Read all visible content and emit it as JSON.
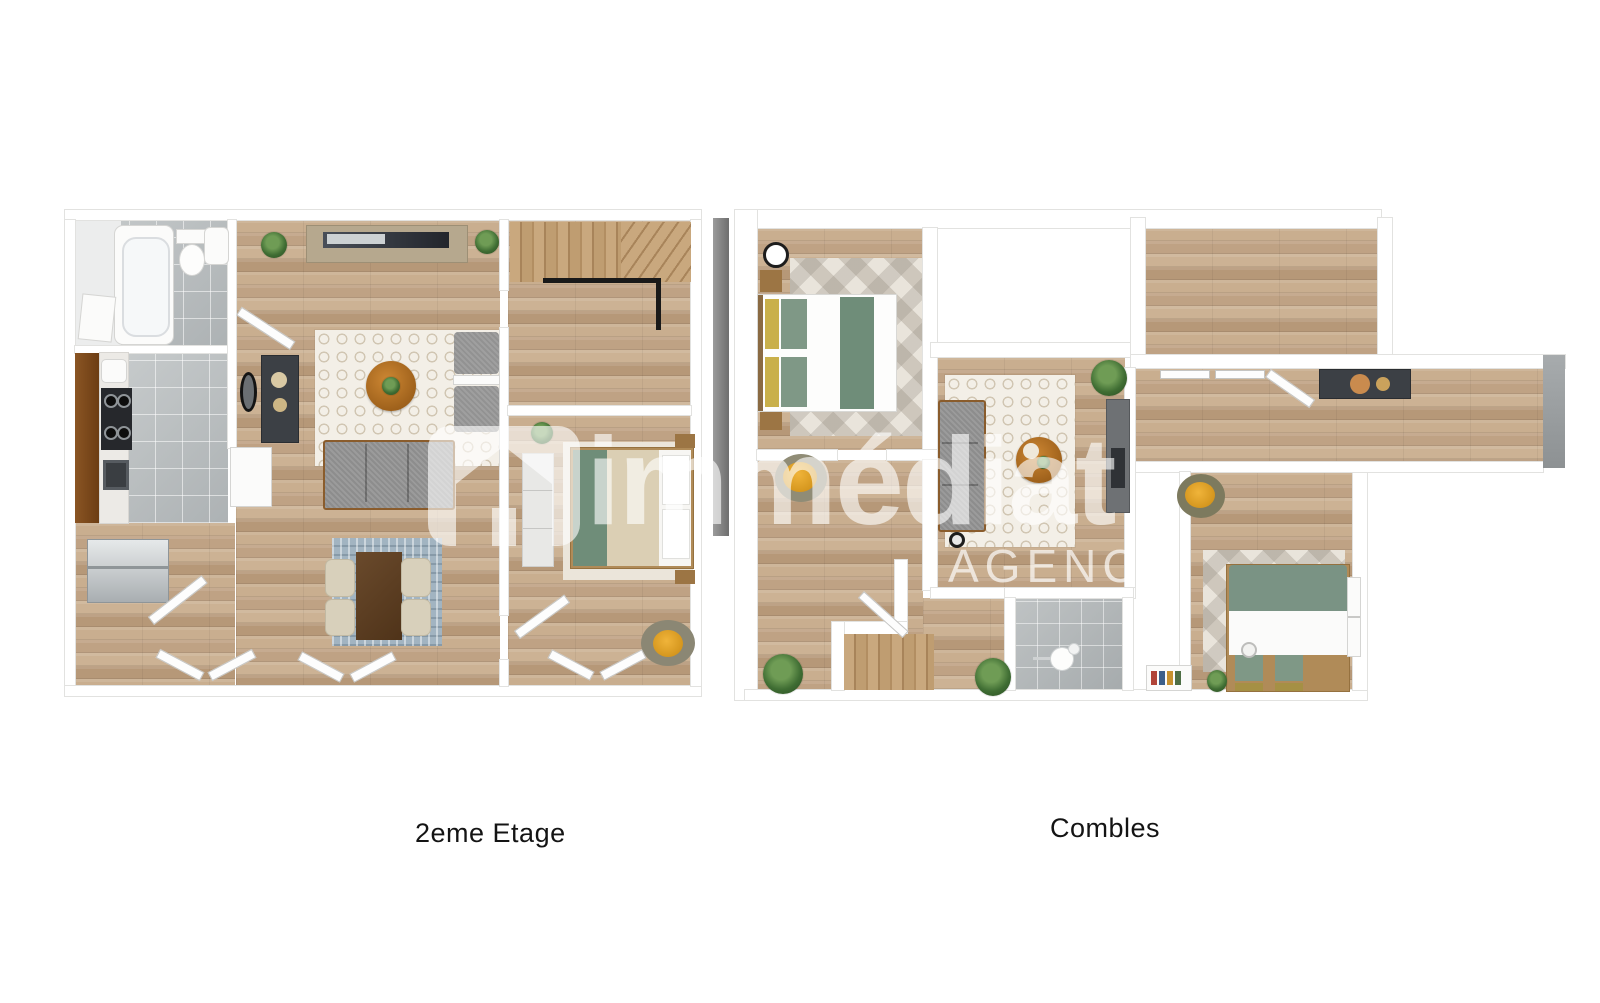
{
  "page": {
    "background_color": "#ffffff"
  },
  "watermark": {
    "brand": "immédiat",
    "subtitle": "AGENCE",
    "icon": "house-logo-icon",
    "color": "#ffffff"
  },
  "floor_plans": [
    {
      "id": "second-floor",
      "label": "2eme Etage",
      "rooms": [
        "bathroom",
        "kitchen",
        "living-room",
        "dining-area",
        "staircase-hall",
        "bedroom"
      ]
    },
    {
      "id": "attic",
      "label": "Combles",
      "rooms": [
        "bedroom-1",
        "void",
        "sitting-area",
        "empty-room",
        "corridor",
        "bedroom-2",
        "shower-room",
        "landing"
      ]
    }
  ],
  "colors": {
    "wood_floor": "#c4a787",
    "tile_floor": "#bdc1c3",
    "wall": "#ffffff",
    "wall_outline": "#e2e2e0",
    "sofa_gray": "#8d8d8d",
    "accent_green": "#6f8d79",
    "accent_yellow": "#e2a32a",
    "accent_olive": "#a59044",
    "table_wood": "#b06f24",
    "rug_white": "#f3efe7",
    "rug_blue": "#a2b4c1",
    "cabinet_brown": "#7a4a1e",
    "dark_furniture": "#3c4045"
  }
}
